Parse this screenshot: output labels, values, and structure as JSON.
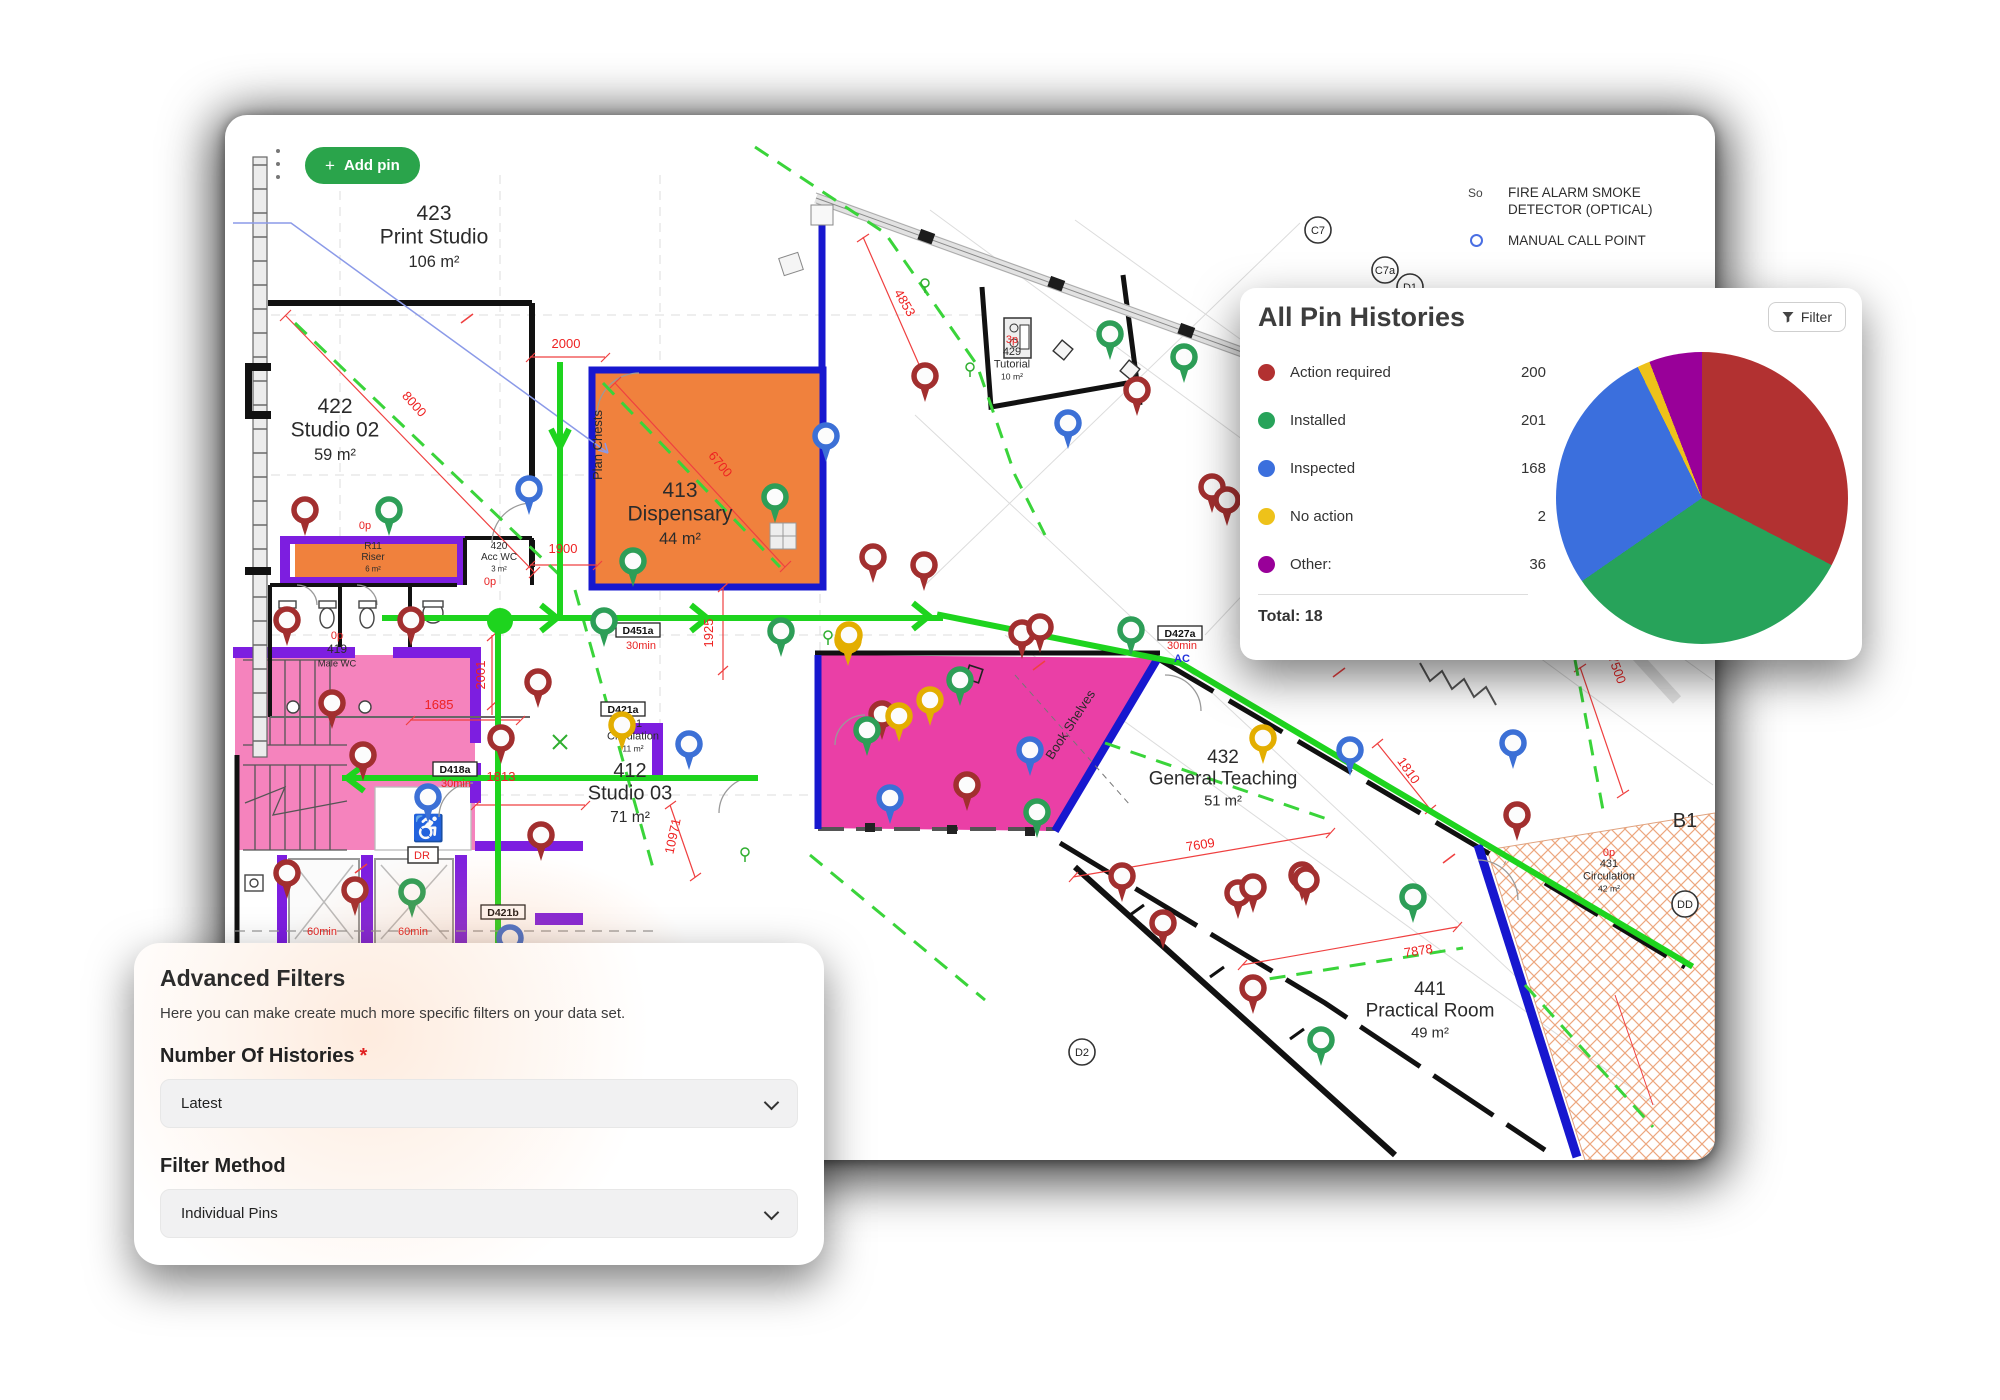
{
  "header": {
    "add_pin_label": "Add pin",
    "plus": "+",
    "kebab_menu": "more-options"
  },
  "map_legend": {
    "smoke_symbol": "So",
    "smoke_label": "FIRE ALARM SMOKE DETECTOR (OPTICAL)",
    "call_point_label": "MANUAL CALL POINT"
  },
  "histories_panel": {
    "title": "All Pin Histories",
    "filter_label": "Filter",
    "total_label": "Total: 18"
  },
  "chart_data": {
    "type": "pie",
    "title": "All Pin Histories",
    "legend_position": "left",
    "series": [
      {
        "label": "Action required",
        "value": 200,
        "color": "#b23131"
      },
      {
        "label": "Installed",
        "value": 201,
        "color": "#27a35a"
      },
      {
        "label": "Inspected",
        "value": 168,
        "color": "#3b6fdd"
      },
      {
        "label": "No action",
        "value": 2,
        "color": "#eec21a"
      },
      {
        "label": "Other:",
        "value": 36,
        "color": "#990099"
      }
    ],
    "total_shown": 18
  },
  "filters_panel": {
    "title": "Advanced Filters",
    "description": "Here you can make create much more specific filters on your data set.",
    "fields": [
      {
        "label": "Number Of Histories",
        "required_marker": "*",
        "value": "Latest"
      },
      {
        "label": "Filter Method",
        "required_marker": "",
        "value": "Individual Pins"
      }
    ]
  },
  "floor_plan": {
    "pin_colors": {
      "r": "#a22f2f",
      "g": "#2d9e57",
      "b": "#3c70d6",
      "y": "#e3ae00"
    },
    "pins": [
      [
        80,
        395,
        "r"
      ],
      [
        164,
        395,
        "g"
      ],
      [
        304,
        374,
        "b"
      ],
      [
        550,
        382,
        "g"
      ],
      [
        601,
        321,
        "b"
      ],
      [
        648,
        442,
        "r"
      ],
      [
        699,
        450,
        "r"
      ],
      [
        556,
        516,
        "g"
      ],
      [
        623,
        525,
        "y"
      ],
      [
        408,
        446,
        "g"
      ],
      [
        379,
        506,
        "g"
      ],
      [
        62,
        505,
        "r"
      ],
      [
        186,
        505,
        "r"
      ],
      [
        107,
        588,
        "r"
      ],
      [
        138,
        640,
        "r"
      ],
      [
        203,
        682,
        "b"
      ],
      [
        276,
        623,
        "r"
      ],
      [
        313,
        567,
        "r"
      ],
      [
        316,
        720,
        "r"
      ],
      [
        397,
        610,
        "y"
      ],
      [
        885,
        219,
        "g"
      ],
      [
        959,
        242,
        "g"
      ],
      [
        912,
        275,
        "r"
      ],
      [
        843,
        308,
        "b"
      ],
      [
        700,
        261,
        "r"
      ],
      [
        987,
        372,
        "r"
      ],
      [
        1002,
        385,
        "r"
      ],
      [
        624,
        520,
        "y"
      ],
      [
        735,
        565,
        "g"
      ],
      [
        705,
        585,
        "y"
      ],
      [
        657,
        599,
        "r"
      ],
      [
        674,
        601,
        "y"
      ],
      [
        642,
        615,
        "g"
      ],
      [
        797,
        518,
        "r"
      ],
      [
        815,
        512,
        "r"
      ],
      [
        906,
        515,
        "g"
      ],
      [
        805,
        635,
        "b"
      ],
      [
        742,
        670,
        "r"
      ],
      [
        665,
        683,
        "b"
      ],
      [
        812,
        697,
        "g"
      ],
      [
        1125,
        635,
        "b"
      ],
      [
        1288,
        628,
        "b"
      ],
      [
        1292,
        700,
        "r"
      ],
      [
        1077,
        760,
        "r"
      ],
      [
        1188,
        782,
        "g"
      ],
      [
        1038,
        623,
        "y"
      ],
      [
        897,
        761,
        "r"
      ],
      [
        938,
        808,
        "r"
      ],
      [
        1013,
        778,
        "r"
      ],
      [
        1028,
        772,
        "r"
      ],
      [
        1081,
        765,
        "r"
      ],
      [
        1028,
        873,
        "r"
      ],
      [
        1096,
        925,
        "g"
      ],
      [
        62,
        758,
        "r"
      ],
      [
        130,
        775,
        "r"
      ],
      [
        187,
        777,
        "g"
      ],
      [
        285,
        823,
        "b"
      ],
      [
        464,
        629,
        "b"
      ]
    ],
    "room_labels": [
      {
        "x": 209,
        "y": 105,
        "size": 21,
        "lines": [
          "423",
          "Print Studio",
          "106 m²"
        ]
      },
      {
        "x": 110,
        "y": 298,
        "size": 21,
        "lines": [
          "422",
          "Studio 02",
          "59 m²"
        ]
      },
      {
        "x": 455,
        "y": 382,
        "size": 21,
        "lines": [
          "413",
          "Dispensary",
          "44 m²"
        ]
      },
      {
        "x": 148,
        "y": 434,
        "size": 10,
        "lines": [
          "R11",
          "Riser",
          "6 m²"
        ]
      },
      {
        "x": 274,
        "y": 434,
        "size": 10,
        "lines": [
          "420",
          "Acc WC",
          "3 m²"
        ]
      },
      {
        "x": 112,
        "y": 538,
        "size": 12,
        "lines": [
          "419",
          "Male WC"
        ]
      },
      {
        "x": 408,
        "y": 612,
        "size": 11,
        "lines": [
          "421",
          "Circulation",
          "11 m²"
        ]
      },
      {
        "x": 405,
        "y": 662,
        "size": 20,
        "lines": [
          "412",
          "Studio 03",
          "71 m²"
        ]
      },
      {
        "x": 787,
        "y": 240,
        "size": 11,
        "lines": [
          "429",
          "Tutorial",
          "10 m²"
        ]
      },
      {
        "x": 998,
        "y": 648,
        "size": 19,
        "lines": [
          "432",
          "General Teaching",
          "51 m²"
        ]
      },
      {
        "x": 1205,
        "y": 880,
        "size": 19,
        "lines": [
          "441",
          "Practical Room",
          "49 m²"
        ]
      },
      {
        "x": 1384,
        "y": 752,
        "size": 11,
        "lines": [
          "431",
          "Circulation",
          "42 m²"
        ]
      },
      {
        "x": 377,
        "y": 330,
        "size": 13,
        "rot": -90,
        "lines": [
          "Plan Chests"
        ]
      },
      {
        "x": 849,
        "y": 612,
        "size": 13,
        "rot": -57,
        "lines": [
          "Book Shelves"
        ]
      },
      {
        "x": 1460,
        "y": 712,
        "size": 20,
        "lines": [
          "B1"
        ]
      }
    ],
    "dimensions": [
      {
        "t": "2000",
        "x": 341,
        "y": 233,
        "rot": 0
      },
      {
        "t": "8000",
        "x": 186,
        "y": 292,
        "rot": 48
      },
      {
        "t": "6700",
        "x": 492,
        "y": 352,
        "rot": 50
      },
      {
        "t": "1900",
        "x": 338,
        "y": 438,
        "rot": 0
      },
      {
        "t": "1925",
        "x": 488,
        "y": 518,
        "rot": -90
      },
      {
        "t": "2001",
        "x": 260,
        "y": 560,
        "rot": -90
      },
      {
        "t": "1685",
        "x": 214,
        "y": 594,
        "rot": 0
      },
      {
        "t": "1813",
        "x": 276,
        "y": 666,
        "rot": 0
      },
      {
        "t": "10971",
        "x": 452,
        "y": 722,
        "rot": -78
      },
      {
        "t": "4853",
        "x": 676,
        "y": 190,
        "rot": 60
      },
      {
        "t": "7609",
        "x": 976,
        "y": 734,
        "rot": -9
      },
      {
        "t": "7878",
        "x": 1194,
        "y": 840,
        "rot": -9
      },
      {
        "t": "1810",
        "x": 1180,
        "y": 658,
        "rot": 55
      },
      {
        "t": "7500",
        "x": 1388,
        "y": 556,
        "rot": 70
      }
    ],
    "small_red_texts": [
      {
        "t": "0p",
        "x": 112,
        "y": 524
      },
      {
        "t": "0p",
        "x": 140,
        "y": 414
      },
      {
        "t": "0p",
        "x": 265,
        "y": 470
      },
      {
        "t": "3p",
        "x": 787,
        "y": 228
      },
      {
        "t": "0p",
        "x": 1384,
        "y": 741
      },
      {
        "t": "60min",
        "x": 97,
        "y": 820
      },
      {
        "t": "60min",
        "x": 188,
        "y": 820
      },
      {
        "t": "30min",
        "x": 416,
        "y": 534
      },
      {
        "t": "30min",
        "x": 231,
        "y": 672
      },
      {
        "t": "30min",
        "x": 957,
        "y": 534
      },
      {
        "t": "DR",
        "x": 197,
        "y": 744
      }
    ],
    "small_blue_texts": [
      {
        "t": "AC",
        "x": 957,
        "y": 547
      }
    ],
    "door_labels": [
      {
        "t": "D451a",
        "x": 413,
        "y": 518
      },
      {
        "t": "D421a",
        "x": 398,
        "y": 597
      },
      {
        "t": "D418a",
        "x": 230,
        "y": 657
      },
      {
        "t": "D427a",
        "x": 955,
        "y": 521
      },
      {
        "t": "D421b",
        "x": 278,
        "y": 800
      }
    ],
    "circle_markers": [
      {
        "t": "C7",
        "x": 1093,
        "y": 115
      },
      {
        "t": "C7a",
        "x": 1160,
        "y": 155
      },
      {
        "t": "D1",
        "x": 1185,
        "y": 172
      },
      {
        "t": "D2",
        "x": 857,
        "y": 937
      },
      {
        "t": "DD",
        "x": 1460,
        "y": 789
      }
    ]
  }
}
